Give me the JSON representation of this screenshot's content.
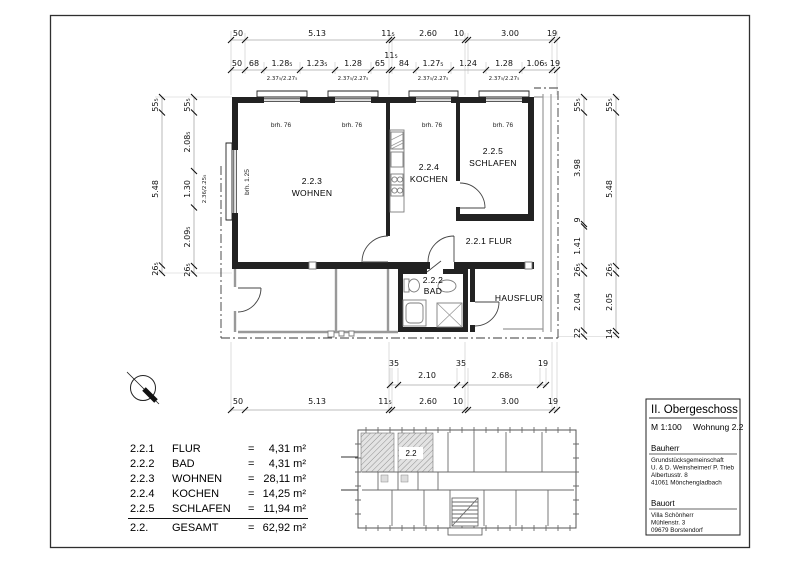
{
  "drawing": {
    "rooms": {
      "wohnen": {
        "nr": "2.2.3",
        "name": "WOHNEN"
      },
      "kochen": {
        "nr": "2.2.4",
        "name": "KOCHEN"
      },
      "schlafen": {
        "nr": "2.2.5",
        "name": "SCHLAFEN"
      },
      "flur": {
        "label": "2.2.1 FLUR"
      },
      "bad": {
        "nr": "2.2.2",
        "name": "BAD"
      },
      "hausflur": {
        "label": "HAUSFLUR"
      }
    },
    "annotations": {
      "brh_window": "brh. 76",
      "brh_left_window": "brh. 1.25",
      "window_size_top": "2.37₅/2.27₅",
      "window_size_left": "2.36/2.25₅"
    },
    "dims": {
      "top1": [
        "50",
        "5.13",
        "11₅",
        "2.60",
        "10",
        "3.00",
        "19"
      ],
      "top2": [
        "50",
        "68",
        "1.28₅",
        "1.23₅",
        "1.28",
        "65",
        "84",
        "1.27₅",
        "1.24",
        "1.28",
        "1.06₅",
        "19"
      ],
      "top2_above": "11₅",
      "left_outer": [
        "55₅",
        "5.48",
        "26₅"
      ],
      "left_inner": [
        "55₅",
        "2.08₅",
        "1.30",
        "2.09₅",
        "26₅"
      ],
      "right_inner": [
        "55₅",
        "3.98",
        "9",
        "1.41",
        "26₅",
        "2.04",
        "22"
      ],
      "right_outer": [
        "55₅",
        "5.48",
        "26₅",
        "2.05",
        "14"
      ],
      "bottom_upper": [
        "35",
        "2.10",
        "35",
        "2.68₅",
        "19"
      ],
      "bottom_lower": [
        "50",
        "5.13",
        "11₅",
        "2.60",
        "10",
        "3.00",
        "19"
      ]
    }
  },
  "overview": {
    "unit_label": "2.2"
  },
  "room_table": {
    "rows": [
      {
        "nr": "2.2.1",
        "name": "FLUR",
        "eq": "=",
        "area": "4,31 m²"
      },
      {
        "nr": "2.2.2",
        "name": "BAD",
        "eq": "=",
        "area": "4,31 m²"
      },
      {
        "nr": "2.2.3",
        "name": "WOHNEN",
        "eq": "=",
        "area": "28,11 m²"
      },
      {
        "nr": "2.2.4",
        "name": "KOCHEN",
        "eq": "=",
        "area": "14,25 m²"
      },
      {
        "nr": "2.2.5",
        "name": "SCHLAFEN",
        "eq": "=",
        "area": "11,94 m²"
      },
      {
        "nr": "2.2.",
        "name": "GESAMT",
        "eq": "=",
        "area": "62,92 m²"
      }
    ]
  },
  "title_block": {
    "title": "II. Obergeschoss",
    "scale": "M 1:100",
    "unit": "Wohnung 2.2",
    "client_label": "Bauherr",
    "client_lines": [
      "Grundstücksgemeinschaft",
      "U. & D. Weinsheimer/ P. Trieb",
      "Albertusstr. 8",
      "41061 Mönchengladbach"
    ],
    "site_label": "Bauort",
    "site_lines": [
      "Villa Schönherr",
      "Mühlenstr. 3",
      "09679 Borstendorf"
    ]
  }
}
